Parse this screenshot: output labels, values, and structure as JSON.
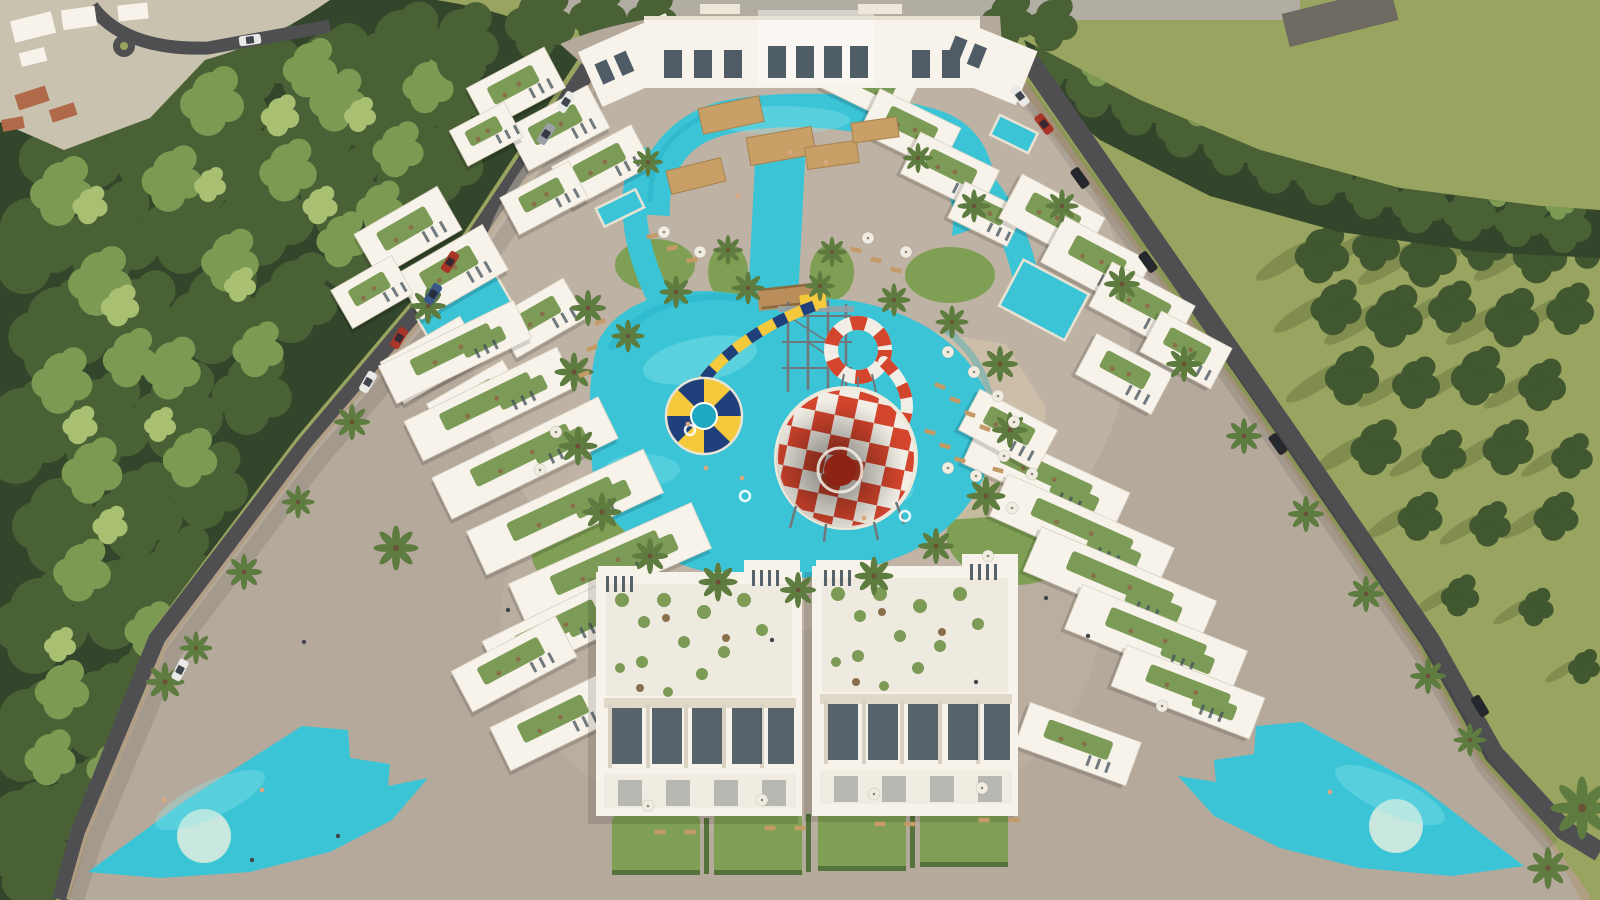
{
  "scene": {
    "type": "aerial-architectural-render",
    "elements": [
      "pine-forest",
      "meadow",
      "perimeter-road",
      "boundary-wall",
      "paved-plaza",
      "clubhouse",
      "apartment-blocks",
      "roof-gardens",
      "lagoon-pool",
      "main-pool",
      "kids-waterpark",
      "checkered-funnel-slide",
      "striped-loop-slide",
      "yellow-tube-slide",
      "blue-yellow-funnel",
      "decorative-pool-left",
      "decorative-pool-right",
      "palm-trees",
      "sun-umbrellas",
      "sun-loungers",
      "cars",
      "pedestrians",
      "swimmers"
    ]
  },
  "colors": {
    "field": "#98a45f",
    "fieldShadow": "#68763f",
    "fieldPine": "#41572f",
    "forestDark": "#33452a",
    "forestMid": "#4a6135",
    "forestLight": "#7d9a52",
    "forestTip": "#a9bf72",
    "road": "#4f4f52",
    "topRoad": "#b2ada3",
    "wall": "#b19f85",
    "wallShadow": "#86765f",
    "pavement": "#b5a99c",
    "courtyard": "#c8bcab",
    "townGround": "#c9c2ae",
    "greyRoof": "#6e6961",
    "redRoof": "#b06a4a",
    "lawn": "#7fa054",
    "hedge": "#55723a",
    "beach": "#cdbfa9",
    "pool": "#3ac4d6",
    "poolDeep": "#1fa9c0",
    "poolLight": "#8fe6ec",
    "island": "#c8e7de",
    "deck": "#e9e3d4",
    "building": "#f7f3ea",
    "roofTerrace": "#efeadf",
    "roofGarden": "#7c9b56",
    "planter": "#8a6f4b",
    "window": "#41505a",
    "pergola": "#c89f66",
    "bridge": "#b98e5a",
    "towerGrey": "#71767b",
    "funnelRed": "#d4452d",
    "funnelDark": "#8e2214",
    "funnelWhite": "#f2eee5",
    "slideNavy": "#20407c",
    "slideYellow": "#f4c93c",
    "palmGreen": "#5e7c3f",
    "umbrella": "#f1ece1",
    "sunbed": "#c49a66",
    "figure": "#40454b",
    "skinTone": "#d8a97e",
    "carWhite": "#e9e9e7",
    "carGrey": "#9aa0a6",
    "carRed": "#a83527",
    "carBlue": "#3c5a88",
    "carBlack": "#26282c"
  },
  "layout": {
    "pines_dark": [
      [
        170,
        44,
        2.6
      ],
      [
        185,
        70,
        3.1
      ],
      [
        255,
        40,
        2.9
      ],
      [
        330,
        62,
        3
      ],
      [
        402,
        38,
        2.8
      ],
      [
        455,
        80,
        2.4
      ],
      [
        70,
        140,
        3.2
      ],
      [
        150,
        128,
        2.9
      ],
      [
        228,
        132,
        3.1
      ],
      [
        308,
        118,
        2.8
      ],
      [
        388,
        108,
        2.9
      ],
      [
        445,
        150,
        2.4
      ],
      [
        30,
        228,
        3
      ],
      [
        108,
        222,
        3.2
      ],
      [
        188,
        210,
        2.9
      ],
      [
        266,
        200,
        3
      ],
      [
        344,
        182,
        2.7
      ],
      [
        415,
        165,
        2.4
      ],
      [
        58,
        318,
        3.1
      ],
      [
        138,
        308,
        2.9
      ],
      [
        218,
        298,
        3
      ],
      [
        296,
        286,
        2.6
      ],
      [
        360,
        255,
        2.3
      ],
      [
        22,
        418,
        3
      ],
      [
        100,
        410,
        3.1
      ],
      [
        178,
        398,
        2.8
      ],
      [
        252,
        380,
        2.5
      ],
      [
        60,
        508,
        3
      ],
      [
        138,
        498,
        2.8
      ],
      [
        208,
        474,
        2.5
      ],
      [
        40,
        608,
        3
      ],
      [
        118,
        588,
        2.8
      ],
      [
        178,
        556,
        2.4
      ],
      [
        28,
        718,
        2.9
      ],
      [
        98,
        698,
        2.7
      ],
      [
        152,
        658,
        2.3
      ],
      [
        20,
        818,
        2.8
      ],
      [
        82,
        788,
        2.5
      ],
      [
        40,
        868,
        2.4
      ]
    ],
    "pines_light": [
      [
        212,
        92,
        2
      ],
      [
        338,
        92,
        1.8
      ],
      [
        428,
        78,
        1.6
      ],
      [
        62,
        182,
        2
      ],
      [
        172,
        170,
        1.9
      ],
      [
        288,
        162,
        1.8
      ],
      [
        398,
        142,
        1.6
      ],
      [
        100,
        272,
        2
      ],
      [
        230,
        252,
        1.8
      ],
      [
        342,
        232,
        1.6
      ],
      [
        62,
        372,
        1.9
      ],
      [
        172,
        360,
        1.8
      ],
      [
        258,
        342,
        1.6
      ],
      [
        92,
        462,
        1.9
      ],
      [
        190,
        450,
        1.7
      ],
      [
        82,
        562,
        1.8
      ],
      [
        150,
        622,
        1.6
      ],
      [
        62,
        682,
        1.7
      ],
      [
        112,
        760,
        1.6
      ],
      [
        310,
        60,
        1.7
      ],
      [
        380,
        200,
        1.5
      ],
      [
        130,
        350,
        1.7
      ],
      [
        50,
        750,
        1.6
      ]
    ],
    "pines_tip": [
      [
        280,
        110,
        1.2
      ],
      [
        90,
        200,
        1.1
      ],
      [
        210,
        180,
        1
      ],
      [
        320,
        200,
        1.1
      ],
      [
        120,
        300,
        1.2
      ],
      [
        240,
        280,
        1
      ],
      [
        80,
        420,
        1.1
      ],
      [
        160,
        420,
        1
      ],
      [
        110,
        520,
        1.1
      ],
      [
        60,
        640,
        1
      ],
      [
        360,
        110,
        1
      ]
    ],
    "pines_top": [
      [
        540,
        12,
        2.2
      ],
      [
        598,
        6,
        1.8
      ],
      [
        652,
        10,
        1.6
      ],
      [
        1008,
        12,
        1.7
      ],
      [
        1052,
        16,
        1.6
      ],
      [
        462,
        32,
        2.3
      ]
    ],
    "band_pines": [
      [
        1052,
        52,
        1.8
      ],
      [
        1096,
        76,
        1.9
      ],
      [
        1140,
        96,
        1.8
      ],
      [
        1186,
        116,
        1.9
      ],
      [
        1232,
        136,
        1.8
      ],
      [
        1278,
        152,
        1.9
      ],
      [
        1324,
        166,
        1.8
      ],
      [
        1372,
        182,
        1.7
      ],
      [
        1420,
        194,
        1.8
      ],
      [
        1470,
        204,
        1.7
      ],
      [
        1520,
        212,
        1.6
      ],
      [
        1566,
        218,
        1.6
      ],
      [
        1076,
        34,
        1.5
      ],
      [
        1160,
        64,
        1.5
      ],
      [
        1250,
        106,
        1.5
      ],
      [
        1340,
        136,
        1.4
      ],
      [
        1440,
        168,
        1.4
      ],
      [
        1540,
        190,
        1.3
      ]
    ],
    "band_light": [
      [
        1100,
        60,
        1.2
      ],
      [
        1200,
        100,
        1.2
      ],
      [
        1300,
        130,
        1.1
      ],
      [
        1400,
        160,
        1.1
      ],
      [
        1500,
        185,
        1
      ],
      [
        1560,
        200,
        0.9
      ]
    ],
    "field_pines": [
      [
        1322,
        246,
        1.7
      ],
      [
        1376,
        238,
        1.5
      ],
      [
        1428,
        248,
        1.8
      ],
      [
        1484,
        238,
        1.5
      ],
      [
        1540,
        246,
        1.7
      ],
      [
        1590,
        238,
        1.4
      ],
      [
        1336,
        300,
        1.6
      ],
      [
        1394,
        308,
        1.8
      ],
      [
        1452,
        300,
        1.5
      ],
      [
        1512,
        310,
        1.7
      ],
      [
        1570,
        302,
        1.5
      ],
      [
        1352,
        368,
        1.7
      ],
      [
        1416,
        376,
        1.5
      ],
      [
        1478,
        368,
        1.7
      ],
      [
        1542,
        378,
        1.5
      ],
      [
        1376,
        440,
        1.6
      ],
      [
        1444,
        448,
        1.4
      ],
      [
        1508,
        440,
        1.6
      ],
      [
        1572,
        450,
        1.3
      ],
      [
        1420,
        510,
        1.4
      ],
      [
        1490,
        518,
        1.3
      ],
      [
        1556,
        510,
        1.4
      ],
      [
        1460,
        590,
        1.2
      ],
      [
        1536,
        602,
        1.1
      ],
      [
        1584,
        662,
        1
      ]
    ],
    "palms": [
      [
        588,
        308,
        1.2
      ],
      [
        574,
        372,
        1.3
      ],
      [
        578,
        446,
        1.3
      ],
      [
        602,
        512,
        1.3
      ],
      [
        650,
        556,
        1.2
      ],
      [
        718,
        582,
        1.3
      ],
      [
        798,
        590,
        1.2
      ],
      [
        874,
        576,
        1.3
      ],
      [
        936,
        546,
        1.2
      ],
      [
        986,
        496,
        1.3
      ],
      [
        1010,
        430,
        1.2
      ],
      [
        1000,
        364,
        1.2
      ],
      [
        952,
        322,
        1.1
      ],
      [
        894,
        300,
        1.1
      ],
      [
        748,
        288,
        1.1
      ],
      [
        676,
        292,
        1.1
      ],
      [
        628,
        336,
        1.1
      ],
      [
        820,
        286,
        1
      ],
      [
        648,
        162,
        1
      ],
      [
        918,
        158,
        1
      ],
      [
        974,
        206,
        1.1
      ],
      [
        428,
        306,
        1.2
      ],
      [
        352,
        422,
        1.2
      ],
      [
        298,
        502,
        1.1
      ],
      [
        244,
        572,
        1.2
      ],
      [
        196,
        648,
        1.1
      ],
      [
        396,
        548,
        1.5
      ],
      [
        165,
        682,
        1.3
      ],
      [
        1062,
        206,
        1.1
      ],
      [
        1122,
        284,
        1.2
      ],
      [
        1184,
        364,
        1.2
      ],
      [
        1244,
        436,
        1.2
      ],
      [
        1306,
        514,
        1.2
      ],
      [
        1366,
        594,
        1.2
      ],
      [
        1428,
        676,
        1.2
      ],
      [
        1470,
        740,
        1.1
      ],
      [
        1582,
        808,
        2.1
      ],
      [
        1548,
        868,
        1.4
      ],
      [
        728,
        250,
        1
      ],
      [
        832,
        252,
        1
      ]
    ],
    "umbrellas": [
      [
        948,
        352
      ],
      [
        974,
        372
      ],
      [
        998,
        396
      ],
      [
        1014,
        422
      ],
      [
        1004,
        456
      ],
      [
        976,
        476
      ],
      [
        948,
        468
      ],
      [
        1032,
        474
      ],
      [
        1012,
        508
      ],
      [
        988,
        556
      ],
      [
        664,
        232
      ],
      [
        700,
        252
      ],
      [
        868,
        238
      ],
      [
        906,
        252
      ],
      [
        648,
        806
      ],
      [
        762,
        800
      ],
      [
        874,
        794
      ],
      [
        982,
        788
      ],
      [
        556,
        432
      ],
      [
        540,
        470
      ],
      [
        1162,
        706
      ]
    ],
    "sunbeds": [
      [
        940,
        386,
        20
      ],
      [
        955,
        400,
        20
      ],
      [
        970,
        414,
        20
      ],
      [
        985,
        428,
        20
      ],
      [
        930,
        432,
        15
      ],
      [
        945,
        446,
        15
      ],
      [
        960,
        460,
        15
      ],
      [
        998,
        470,
        15
      ],
      [
        600,
        322,
        -20
      ],
      [
        592,
        348,
        -20
      ],
      [
        584,
        374,
        -20
      ],
      [
        652,
        236,
        -12
      ],
      [
        672,
        248,
        -12
      ],
      [
        692,
        260,
        -12
      ],
      [
        856,
        250,
        12
      ],
      [
        876,
        260,
        12
      ],
      [
        896,
        270,
        12
      ],
      [
        660,
        832,
        0
      ],
      [
        690,
        832,
        0
      ],
      [
        770,
        828,
        0
      ],
      [
        800,
        828,
        0
      ],
      [
        880,
        824,
        0
      ],
      [
        910,
        824,
        0
      ],
      [
        984,
        820,
        0
      ],
      [
        1014,
        820,
        0
      ]
    ],
    "people": [
      [
        1046,
        598
      ],
      [
        1088,
        636
      ],
      [
        976,
        682
      ],
      [
        304,
        642
      ],
      [
        338,
        836
      ],
      [
        252,
        860
      ],
      [
        772,
        640
      ],
      [
        508,
        610
      ]
    ],
    "swimmers": [
      [
        742,
        478
      ],
      [
        706,
        468
      ],
      [
        864,
        518
      ],
      [
        790,
        152
      ],
      [
        826,
        162
      ],
      [
        688,
        424
      ],
      [
        164,
        800
      ],
      [
        262,
        790
      ],
      [
        1330,
        792
      ],
      [
        738,
        196
      ]
    ],
    "cars": [
      [
        566,
        102,
        -57,
        "carWhite"
      ],
      [
        546,
        134,
        -57,
        "carGrey"
      ],
      [
        450,
        262,
        -58,
        "carRed"
      ],
      [
        433,
        294,
        -58,
        "carBlue"
      ],
      [
        399,
        338,
        -59,
        "carRed"
      ],
      [
        368,
        382,
        -60,
        "carWhite"
      ],
      [
        180,
        670,
        -63,
        "carWhite"
      ],
      [
        1020,
        96,
        53,
        "carWhite"
      ],
      [
        1044,
        124,
        53,
        "carRed"
      ],
      [
        1080,
        178,
        54,
        "carBlack"
      ],
      [
        1148,
        262,
        54,
        "carBlack"
      ],
      [
        1278,
        444,
        55,
        "carBlack"
      ],
      [
        1480,
        706,
        59,
        "carBlack"
      ],
      [
        250,
        40,
        -8,
        "carWhite"
      ]
    ],
    "blocks": [
      [
        516,
        88,
        88,
        46,
        -28
      ],
      [
        558,
        128,
        92,
        48,
        -28
      ],
      [
        602,
        166,
        90,
        46,
        -28
      ],
      [
        486,
        134,
        62,
        40,
        -28
      ],
      [
        544,
        198,
        78,
        42,
        -28
      ],
      [
        870,
        86,
        86,
        46,
        26
      ],
      [
        910,
        130,
        90,
        48,
        26
      ],
      [
        950,
        172,
        88,
        46,
        26
      ],
      [
        986,
        214,
        66,
        40,
        26
      ],
      [
        408,
        232,
        96,
        50,
        -30
      ],
      [
        452,
        272,
        100,
        52,
        -30
      ],
      [
        372,
        292,
        70,
        44,
        -30
      ],
      [
        432,
        360,
        92,
        48,
        -30
      ],
      [
        476,
        402,
        88,
        46,
        -30
      ],
      [
        540,
        318,
        80,
        46,
        -30
      ],
      [
        455,
        352,
        150,
        42,
        -26
      ],
      [
        490,
        404,
        170,
        44,
        -26
      ],
      [
        525,
        458,
        185,
        46,
        -26
      ],
      [
        565,
        512,
        195,
        48,
        -25
      ],
      [
        610,
        566,
        200,
        50,
        -24
      ],
      [
        560,
        630,
        150,
        48,
        -26
      ],
      [
        514,
        664,
        118,
        46,
        -28
      ],
      [
        556,
        722,
        124,
        48,
        -26
      ],
      [
        1052,
        218,
        94,
        50,
        28
      ],
      [
        1096,
        262,
        98,
        52,
        28
      ],
      [
        1142,
        306,
        94,
        50,
        28
      ],
      [
        1186,
        350,
        80,
        46,
        28
      ],
      [
        1124,
        374,
        86,
        46,
        28
      ],
      [
        1046,
        478,
        165,
        44,
        25
      ],
      [
        1082,
        532,
        182,
        46,
        24
      ],
      [
        1120,
        586,
        190,
        48,
        23
      ],
      [
        1156,
        640,
        178,
        48,
        22
      ],
      [
        1188,
        692,
        148,
        44,
        21
      ],
      [
        1008,
        430,
        88,
        46,
        28
      ],
      [
        1078,
        744,
        118,
        46,
        20
      ]
    ]
  }
}
